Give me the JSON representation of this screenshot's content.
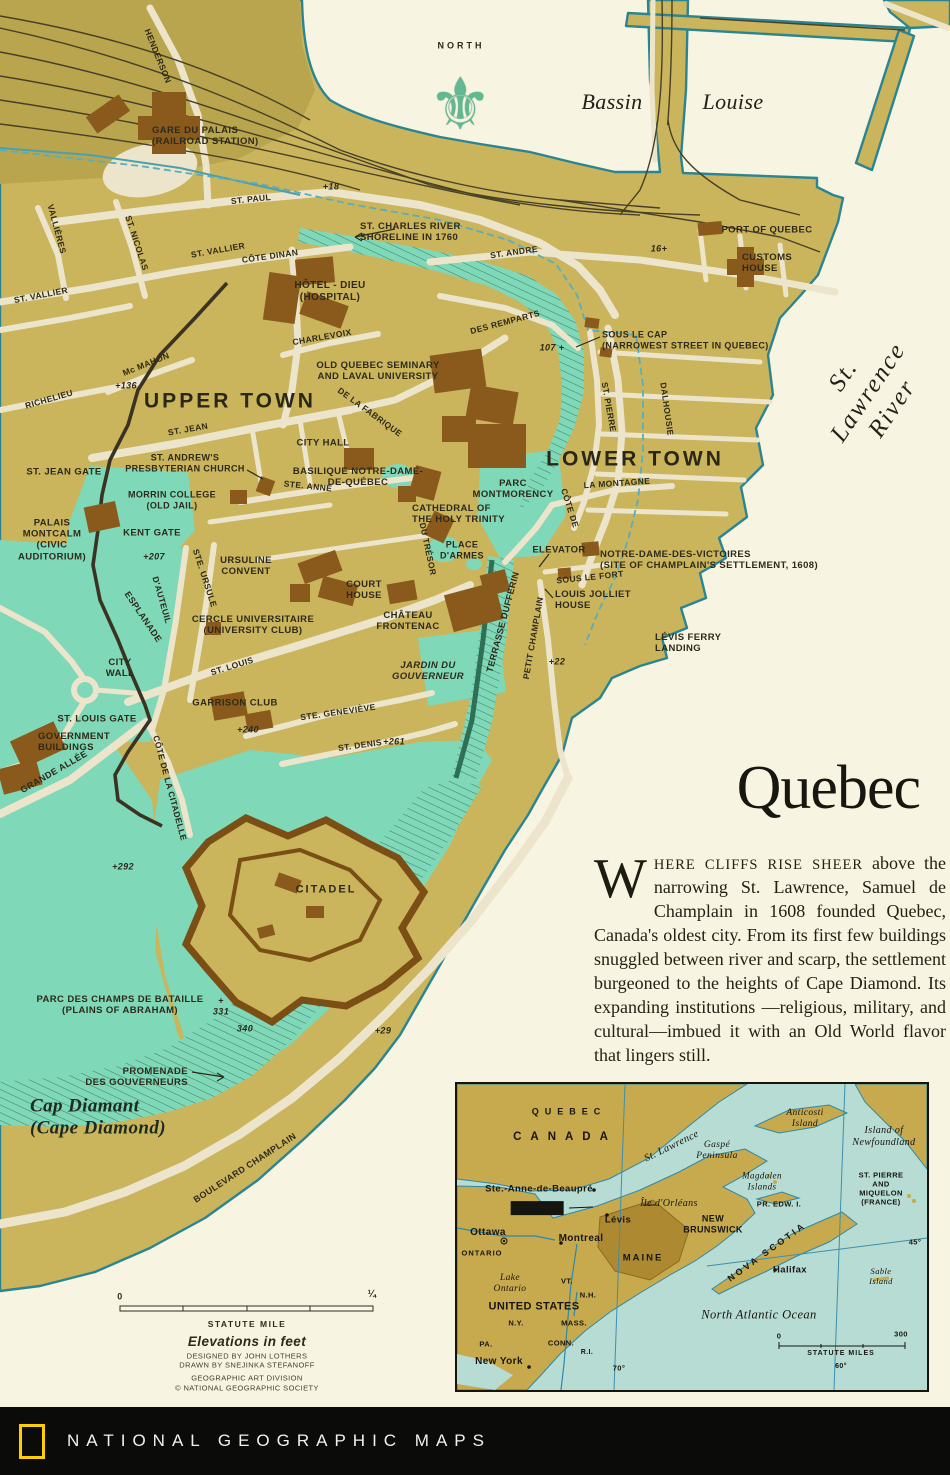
{
  "palette": {
    "land": "#cab45c",
    "land2": "#b9a54d",
    "street": "#ece5cb",
    "water": "#f8f4e2",
    "shore": "#2b8591",
    "park": "#7fd8b8",
    "building": "#8a5a1d",
    "wall": "#3b3322",
    "fortwall": "#7a4e14",
    "rail": "#474026",
    "ink": "#2e2a1a",
    "bluedash": "#58aebe",
    "inwater": "#b6dcd4",
    "inland": "#c7a94e",
    "inmaine": "#ad8a32",
    "inriver": "#2e89a8",
    "brand": "#ffce00",
    "footer_bg": "#0b0b09",
    "title_color": "#17170f"
  },
  "map": {
    "north_icon": "⚜",
    "labels": [
      {
        "t": "NORTH",
        "x": 461,
        "y": 46,
        "s": 9,
        "ls": 3
      },
      {
        "t": "Bassin",
        "x": 612,
        "y": 102,
        "st": "serif-it",
        "s": 22
      },
      {
        "t": "Louise",
        "x": 733,
        "y": 102,
        "st": "serif-it",
        "s": 22
      },
      {
        "n": "label-st-lawrence-river",
        "t": "St. Lawrence River",
        "x": 868,
        "y": 392,
        "r": -56,
        "st": "serif-it",
        "s": 25,
        "ls": 2
      },
      {
        "t": "HENDERSON",
        "x": 158,
        "y": 56,
        "r": 68,
        "s": 8.5
      },
      {
        "n": "label-gare-du-palais",
        "t": "GARE DU PALAIS\n(RAILROAD STATION)",
        "x": 152,
        "y": 136,
        "a": "left",
        "s": 9.5
      },
      {
        "n": "label-st-paul-west",
        "t": "ST. PAUL",
        "x": 251,
        "y": 199,
        "r": -6,
        "s": 8.5
      },
      {
        "t": "+18",
        "x": 331,
        "y": 187,
        "st": "elev"
      },
      {
        "n": "label-st-charles-shoreline",
        "t": "ST. CHARLES RIVER\nSHORELINE IN 1760",
        "x": 360,
        "y": 232,
        "a": "left",
        "s": 9.5
      },
      {
        "t": "VALLIÈRES",
        "x": 57,
        "y": 229,
        "r": 75,
        "s": 8.5
      },
      {
        "t": "ST. NICOLAS",
        "x": 137,
        "y": 243,
        "r": 72,
        "s": 8.5
      },
      {
        "n": "label-st-vallier-east",
        "t": "ST. VALLIER",
        "x": 218,
        "y": 250,
        "r": -10,
        "s": 8.5
      },
      {
        "t": "CÔTE DINAN",
        "x": 270,
        "y": 256,
        "r": -8,
        "s": 8.5
      },
      {
        "t": "ST. ANDRE",
        "x": 514,
        "y": 252,
        "r": -8,
        "s": 8.5
      },
      {
        "t": "16+",
        "x": 659,
        "y": 249,
        "st": "elev"
      },
      {
        "t": "PORT OF QUEBEC",
        "x": 767,
        "y": 230,
        "s": 9.5
      },
      {
        "n": "label-customs-house",
        "t": "CUSTOMS\nHOUSE",
        "x": 742,
        "y": 263,
        "a": "left",
        "s": 9.5
      },
      {
        "n": "label-st-vallier-west",
        "t": "ST. VALLIER",
        "x": 41,
        "y": 295,
        "r": -11,
        "s": 8.5
      },
      {
        "n": "label-hotel-dieu",
        "t": "HÔTEL - DIEU\n(HOSPITAL)",
        "x": 330,
        "y": 292,
        "s": 10
      },
      {
        "t": "DES REMPARTS",
        "x": 505,
        "y": 322,
        "r": -15,
        "s": 8.5
      },
      {
        "t": "107 +",
        "x": 552,
        "y": 348,
        "st": "elev"
      },
      {
        "n": "label-sous-le-cap",
        "t": "SOUS LE CAP\n(NARROWEST STREET IN QUEBEC)",
        "x": 602,
        "y": 340,
        "a": "left",
        "s": 9
      },
      {
        "t": "CHARLEVOIX",
        "x": 322,
        "y": 337,
        "r": -10,
        "s": 8.5
      },
      {
        "n": "label-seminary",
        "t": "OLD QUEBEC SEMINARY\nAND LAVAL UNIVERSITY",
        "x": 378,
        "y": 371,
        "s": 9.5
      },
      {
        "t": "Mc MAHON",
        "x": 146,
        "y": 364,
        "r": -22,
        "s": 8.5
      },
      {
        "t": "+136",
        "x": 126,
        "y": 386,
        "st": "elev"
      },
      {
        "t": "RICHELIEU",
        "x": 49,
        "y": 399,
        "r": -16,
        "s": 8.5
      },
      {
        "n": "label-upper-town",
        "t": "UPPER TOWN",
        "x": 230,
        "y": 402,
        "st": "area",
        "s": 21,
        "ls": 3
      },
      {
        "t": "DE LA FABRIQUE",
        "x": 370,
        "y": 412,
        "r": 36,
        "s": 8.5
      },
      {
        "t": "ST. PIERRE",
        "x": 609,
        "y": 407,
        "r": 80,
        "s": 8.5
      },
      {
        "t": "DALHOUSIE",
        "x": 667,
        "y": 409,
        "r": 82,
        "s": 8.5
      },
      {
        "t": "ST. JEAN",
        "x": 188,
        "y": 429,
        "r": -10,
        "s": 8.5
      },
      {
        "t": "CITY HALL",
        "x": 323,
        "y": 443,
        "s": 9.5
      },
      {
        "n": "label-lower-town",
        "t": "LOWER TOWN",
        "x": 635,
        "y": 460,
        "st": "area",
        "s": 21,
        "ls": 3
      },
      {
        "n": "label-st-andrews",
        "t": "ST. ANDREW'S\nPRESBYTERIAN CHURCH",
        "x": 185,
        "y": 463,
        "s": 9
      },
      {
        "t": "ST. JEAN GATE",
        "x": 64,
        "y": 472,
        "s": 9.5
      },
      {
        "n": "label-basilique",
        "t": "BASILIQUE NOTRE-DAME-\nDE-QUÉBEC",
        "x": 358,
        "y": 477,
        "s": 9.5
      },
      {
        "n": "label-parc-montmorency",
        "t": "PARC\nMONTMORENCY",
        "x": 513,
        "y": 489,
        "s": 9.5
      },
      {
        "t": "LA MONTAGNE",
        "x": 617,
        "y": 483,
        "r": -4,
        "s": 8.5
      },
      {
        "t": "STE.  ANNE",
        "x": 308,
        "y": 486,
        "r": 6,
        "s": 8.5
      },
      {
        "n": "label-morrin-college",
        "t": "MORRIN COLLEGE\n(OLD JAIL)",
        "x": 172,
        "y": 500,
        "s": 9
      },
      {
        "t": "CÔTE DE",
        "x": 570,
        "y": 508,
        "r": 72,
        "s": 8.5
      },
      {
        "n": "label-cathedral",
        "t": "CATHEDRAL OF\nTHE HOLY TRINITY",
        "x": 412,
        "y": 514,
        "a": "left",
        "s": 9.5
      },
      {
        "n": "label-palais-montcalm",
        "t": "PALAIS\nMONTCALM\n(CIVIC\nAUDITORIUM)",
        "x": 52,
        "y": 540,
        "s": 9.5
      },
      {
        "t": "KENT GATE",
        "x": 152,
        "y": 533,
        "s": 9.5
      },
      {
        "n": "label-place-darmes",
        "t": "PLACE\nD'ARMES",
        "x": 462,
        "y": 550,
        "s": 9
      },
      {
        "t": "DU TRÉSOR",
        "x": 428,
        "y": 549,
        "r": 78,
        "s": 8.5
      },
      {
        "t": "ELEVATOR",
        "x": 559,
        "y": 550,
        "s": 9.5
      },
      {
        "n": "label-notre-dame-des-victoires",
        "t": "NOTRE-DAME-DES-VICTOIRES\n(SITE OF CHAMPLAIN'S SETTLEMENT, 1608)",
        "x": 600,
        "y": 560,
        "a": "left",
        "s": 9.5
      },
      {
        "t": "+207",
        "x": 154,
        "y": 557,
        "st": "elev"
      },
      {
        "t": "STE. URSULE",
        "x": 205,
        "y": 578,
        "r": 72,
        "s": 8.5
      },
      {
        "t": "SOUS LE FORT",
        "x": 590,
        "y": 577,
        "r": -6,
        "s": 8.5
      },
      {
        "n": "label-louis-jolliet-house",
        "t": "LOUIS JOLLIET\nHOUSE",
        "x": 555,
        "y": 600,
        "a": "left",
        "s": 9.5
      },
      {
        "n": "label-ursuline-convent",
        "t": "URSULINE\nCONVENT",
        "x": 246,
        "y": 566,
        "s": 9.5
      },
      {
        "t": "ESPLANADE",
        "x": 143,
        "y": 617,
        "r": 56,
        "s": 9
      },
      {
        "t": "D'AUTEUIL",
        "x": 162,
        "y": 600,
        "r": 74,
        "s": 8.5
      },
      {
        "n": "label-cercle-universitaire",
        "t": "CERCLE UNIVERSITAIRE\n(UNIVERSITY CLUB)",
        "x": 253,
        "y": 625,
        "s": 9.5
      },
      {
        "n": "label-court-house",
        "t": "COURT\nHOUSE",
        "x": 364,
        "y": 590,
        "s": 9.5
      },
      {
        "n": "label-chateau-frontenac",
        "t": "CHÂTEAU\nFRONTENAC",
        "x": 408,
        "y": 621,
        "s": 9.5
      },
      {
        "t": "TERRASSE DUFFERIN",
        "x": 503,
        "y": 622,
        "r": -75,
        "s": 9
      },
      {
        "t": "PETIT CHAMPLAIN",
        "x": 533,
        "y": 638,
        "r": -80,
        "s": 8.5
      },
      {
        "n": "label-levis-ferry-landing",
        "t": "LÉVIS FERRY\nLANDING",
        "x": 655,
        "y": 643,
        "a": "left",
        "s": 9.5
      },
      {
        "n": "label-city-wall",
        "t": "CITY\nWALL",
        "x": 120,
        "y": 668,
        "s": 9.5
      },
      {
        "n": "label-jardin-du-gouverneur",
        "t": "JARDIN DU\nGOUVERNEUR",
        "x": 428,
        "y": 671,
        "st": "sans-it",
        "s": 9.5
      },
      {
        "t": "ST. LOUIS",
        "x": 232,
        "y": 666,
        "r": -17,
        "s": 8.5
      },
      {
        "t": "+22",
        "x": 557,
        "y": 662,
        "st": "elev"
      },
      {
        "t": "STE. GENEVIÈVE",
        "x": 338,
        "y": 712,
        "r": -8,
        "s": 8.5
      },
      {
        "t": "GARRISON CLUB",
        "x": 235,
        "y": 703,
        "s": 9.5
      },
      {
        "t": "ST. LOUIS GATE",
        "x": 97,
        "y": 719,
        "s": 9.5
      },
      {
        "t": "+240",
        "x": 248,
        "y": 730,
        "st": "elev"
      },
      {
        "n": "label-government-buildings",
        "t": "GOVERNMENT\nBUILDINGS",
        "x": 38,
        "y": 742,
        "a": "left",
        "s": 9.5
      },
      {
        "t": "ST. DENIS",
        "x": 360,
        "y": 745,
        "r": -8,
        "s": 8.5
      },
      {
        "t": "+261",
        "x": 394,
        "y": 742,
        "st": "elev"
      },
      {
        "t": "GRANDE ALLÉE",
        "x": 54,
        "y": 772,
        "r": -30,
        "s": 9
      },
      {
        "t": "CÔTE DE LA CITADELLE",
        "x": 170,
        "y": 788,
        "r": 75,
        "s": 8.5
      },
      {
        "t": "+292",
        "x": 123,
        "y": 867,
        "st": "elev"
      },
      {
        "t": "CITADEL",
        "x": 326,
        "y": 890,
        "s": 11,
        "ls": 2
      },
      {
        "n": "label-plains-of-abraham",
        "t": "PARC DES CHAMPS DE BATAILLE\n(PLAINS OF ABRAHAM)",
        "x": 120,
        "y": 1005,
        "s": 9.5
      },
      {
        "n": "label-elev-331",
        "t": "+\n331",
        "x": 221,
        "y": 1006,
        "st": "elev"
      },
      {
        "t": "340",
        "x": 245,
        "y": 1029,
        "st": "elev"
      },
      {
        "t": "+29",
        "x": 383,
        "y": 1031,
        "st": "elev"
      },
      {
        "n": "label-promenade-des-gouverneurs",
        "t": "PROMENADE\nDES GOUVERNEURS",
        "x": 188,
        "y": 1077,
        "a": "right",
        "s": 9.5
      },
      {
        "n": "label-cap-diamant",
        "t": "Cap Diamant\n(Cape Diamond)",
        "x": 30,
        "y": 1118,
        "a": "left",
        "st": "serif-it-bold",
        "s": 19
      },
      {
        "t": "BOULEVARD CHAMPLAIN",
        "x": 245,
        "y": 1168,
        "r": -33,
        "s": 9
      },
      {
        "n": "label-scale-zero",
        "t": "0",
        "x": 120,
        "y": 1297,
        "s": 9
      },
      {
        "n": "label-scale-quarter",
        "t": "¼",
        "x": 372,
        "y": 1295,
        "s": 10
      },
      {
        "t": "STATUTE MILE",
        "x": 247,
        "y": 1324,
        "s": 8.5,
        "ls": 1.5
      },
      {
        "n": "label-elevations-note",
        "t": "Elevations in feet",
        "x": 247,
        "y": 1342,
        "st": "sans-it",
        "s": 13.5
      },
      {
        "n": "label-credit-designed",
        "t": "DESIGNED BY JOHN LOTHERS",
        "x": 247,
        "y": 1357,
        "st": "credit"
      },
      {
        "n": "label-credit-drawn",
        "t": "DRAWN BY SNEJINKA STEFANOFF",
        "x": 247,
        "y": 1366,
        "st": "credit"
      },
      {
        "n": "label-credit-division",
        "t": "GEOGRAPHIC ART DIVISION",
        "x": 247,
        "y": 1379,
        "st": "credit"
      },
      {
        "n": "label-credit-society",
        "t": "© NATIONAL GEOGRAPHIC SOCIETY",
        "x": 247,
        "y": 1389,
        "st": "credit"
      }
    ]
  },
  "article": {
    "title": "Quebec",
    "dropcap": "W",
    "lead_smallcaps": "HERE CLIFFS RISE SHEER",
    "lead_rest": " above the narrowing St. Lawrence, Samuel de Champlain in 1608 founded Quebec, Canada's oldest city. From its first few buildings snuggled between river and scarp, the settlement burgeoned to the heights of Cape Diamond. Its expanding institutions —religious, military, and cultural—imbued it with an Old World flavor that lingers still."
  },
  "inset": {
    "labels": [
      {
        "t": "QUEBEC",
        "n": "inset-label-quebec-province",
        "x": 112,
        "y": 28,
        "s": 9,
        "ls": 6
      },
      {
        "t": "CANADA",
        "x": 108,
        "y": 54,
        "s": 11.5,
        "ls": 9
      },
      {
        "n": "inset-label-st-lawrence",
        "t": "St. Lawrence",
        "x": 215,
        "y": 63,
        "r": -26,
        "st": "serif-it",
        "s": 10.5
      },
      {
        "n": "inset-label-gaspe",
        "t": "Gaspé\nPeninsula",
        "x": 260,
        "y": 67,
        "st": "serif-it",
        "s": 9.5
      },
      {
        "n": "inset-label-anticosti",
        "t": "Anticosti\nIsland",
        "x": 348,
        "y": 35,
        "st": "serif-it",
        "s": 9.5
      },
      {
        "n": "inset-label-newfoundland",
        "t": "Island of\nNewfoundland",
        "x": 427,
        "y": 53,
        "st": "serif-it",
        "s": 10
      },
      {
        "n": "inset-label-magdalen",
        "t": "Magdalen\nIslands",
        "x": 305,
        "y": 97,
        "st": "serif-it",
        "s": 9
      },
      {
        "n": "inset-label-st-pierre-miquelon",
        "t": "ST. PIERRE\nAND MIQUELON\n(FRANCE)",
        "x": 424,
        "y": 105,
        "s": 7.5
      },
      {
        "t": "PR. EDW. I.",
        "x": 322,
        "y": 121,
        "s": 7.5
      },
      {
        "t": "Ste.-Anne-de-Beaupré",
        "x": 82,
        "y": 105,
        "s": 9.5
      },
      {
        "n": "inset-label-quebec-star",
        "t": "★",
        "x": 98,
        "y": 123,
        "s": 8,
        "st": "glyph"
      },
      {
        "n": "inset-label-quebec-city",
        "t": "QUEBEC",
        "x": 80,
        "y": 124,
        "st": "box",
        "s": 9.5,
        "ls": 1
      },
      {
        "n": "inset-label-ile-dorleans",
        "t": "Île d'Orléans",
        "x": 212,
        "y": 120,
        "st": "serif-it",
        "s": 10
      },
      {
        "t": "Lévis",
        "x": 161,
        "y": 136,
        "s": 9.5
      },
      {
        "n": "inset-label-new-brunswick",
        "t": "NEW\nBRUNSWICK",
        "x": 256,
        "y": 140,
        "s": 9
      },
      {
        "t": "Ottawa",
        "x": 31,
        "y": 149,
        "s": 10
      },
      {
        "t": "ONTARIO",
        "x": 25,
        "y": 170,
        "s": 7.5,
        "ls": 1
      },
      {
        "t": "Montreal",
        "x": 124,
        "y": 155,
        "s": 10
      },
      {
        "t": "MAINE",
        "x": 186,
        "y": 174,
        "s": 9.5,
        "ls": 2
      },
      {
        "t": "NOVA SCOTIA",
        "x": 310,
        "y": 168,
        "r": -36,
        "s": 9,
        "ls": 3
      },
      {
        "t": "Halifax",
        "x": 333,
        "y": 186,
        "s": 9.5
      },
      {
        "n": "inset-label-sable-island",
        "t": "Sable Island",
        "x": 424,
        "y": 192,
        "st": "serif-it",
        "s": 8.5
      },
      {
        "t": "45°",
        "x": 458,
        "y": 159,
        "s": 7.5
      },
      {
        "n": "inset-label-lake-ontario",
        "t": "Lake\nOntario",
        "x": 53,
        "y": 200,
        "st": "serif-it",
        "s": 9.5
      },
      {
        "t": "VT.",
        "x": 110,
        "y": 198,
        "s": 7.5
      },
      {
        "t": "N.H.",
        "x": 131,
        "y": 212,
        "s": 7.5
      },
      {
        "t": "UNITED STATES",
        "x": 77,
        "y": 223,
        "s": 11,
        "st": "strong"
      },
      {
        "t": "N.Y.",
        "x": 59,
        "y": 240,
        "s": 7.5
      },
      {
        "t": "MASS.",
        "x": 117,
        "y": 240,
        "s": 7.5
      },
      {
        "t": "PA.",
        "x": 29,
        "y": 261,
        "s": 7.5
      },
      {
        "t": "CONN.",
        "x": 104,
        "y": 260,
        "s": 7.5
      },
      {
        "t": "R.I.",
        "x": 130,
        "y": 269,
        "s": 7
      },
      {
        "t": "New York",
        "x": 42,
        "y": 278,
        "s": 10
      },
      {
        "t": "70°",
        "x": 162,
        "y": 285,
        "s": 7.5
      },
      {
        "n": "inset-label-north-atlantic",
        "t": "North Atlantic Ocean",
        "x": 302,
        "y": 231,
        "st": "serif-it",
        "s": 12.5
      },
      {
        "n": "inset-label-scale-zero",
        "t": "0",
        "x": 322,
        "y": 253,
        "s": 7.5
      },
      {
        "n": "inset-label-scale-max",
        "t": "300",
        "x": 444,
        "y": 251,
        "s": 7.5
      },
      {
        "t": "STATUTE MILES",
        "x": 384,
        "y": 270,
        "s": 7,
        "ls": 1
      },
      {
        "t": "60°",
        "x": 384,
        "y": 283,
        "s": 7
      }
    ]
  },
  "footer": {
    "brand": "NATIONAL GEOGRAPHIC MAPS"
  }
}
